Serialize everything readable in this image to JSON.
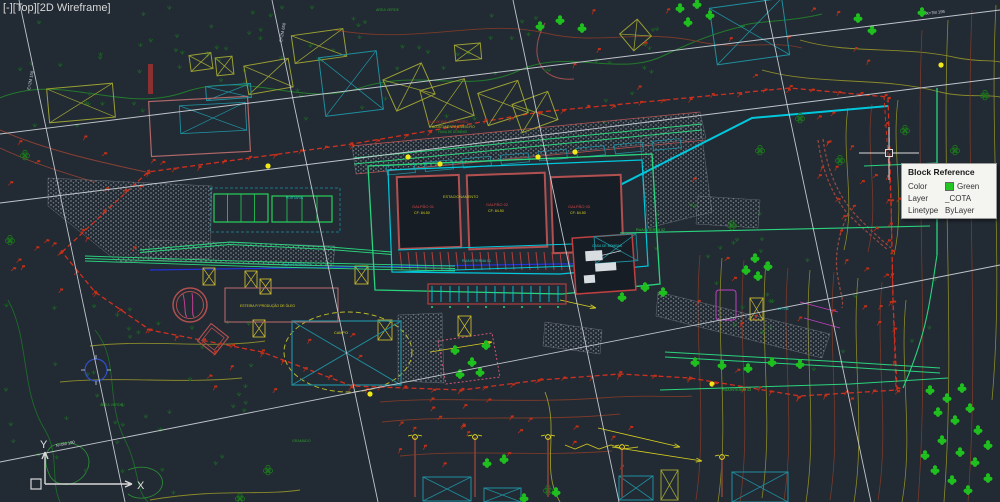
{
  "app": {
    "viewport_controls": {
      "minimize": "[-]",
      "view": "[Top]",
      "visual_style": "[2D Wireframe]"
    }
  },
  "tooltip": {
    "title": "Block Reference",
    "rows": [
      {
        "label": "Color",
        "value": "Green",
        "swatch": "#22c522"
      },
      {
        "label": "Layer",
        "value": "_COTA",
        "swatch": ""
      },
      {
        "label": "Linetype",
        "value": "ByLayer",
        "swatch": ""
      }
    ]
  },
  "ucs": {
    "x_label": "X",
    "y_label": "Y"
  },
  "palette": {
    "background": "#222a33",
    "crosshair": "#dcdcdc",
    "grid_line": "#c9ced5",
    "boundary_red": "#d03020",
    "marker_red": "#c23018",
    "pipe_green": "#2ad47e",
    "plant_green": "#1fbf1f",
    "cad_cyan": "#00c8dc",
    "cad_teal": "#1f8f9f",
    "cad_yellow": "#d8d020",
    "cad_olive": "#9aa033",
    "cad_blue": "#2233dd",
    "cad_salmon": "#b05050",
    "stipple_gray": "#98a0a8"
  },
  "grid_labels": [
    {
      "t": "X=7M 195",
      "x": 926,
      "y": 15,
      "r": -7
    },
    {
      "t": "N=0M 190",
      "x": 56,
      "y": 447,
      "r": -11
    },
    {
      "t": "E=2M 150",
      "x": 30,
      "y": 90,
      "r": -79
    },
    {
      "t": "E=2M 650",
      "x": 282,
      "y": 42,
      "r": -79
    }
  ],
  "drawing_labels": [
    {
      "t": "ESTACIONAMENTO",
      "x": 443,
      "y": 198,
      "c": "#c8c820",
      "s": 3.8
    },
    {
      "t": "GALPÃO 01",
      "x": 412,
      "y": 208,
      "c": "#d04848",
      "s": 4
    },
    {
      "t": "CF: 84.50",
      "x": 414,
      "y": 214,
      "c": "#d8d020",
      "s": 3.6
    },
    {
      "t": "GALPÃO 02",
      "x": 486,
      "y": 206,
      "c": "#d04848",
      "s": 4
    },
    {
      "t": "CF: 84.50",
      "x": 488,
      "y": 212,
      "c": "#d8d020",
      "s": 3.6
    },
    {
      "t": "GALPÃO 03",
      "x": 568,
      "y": 208,
      "c": "#d04848",
      "s": 4
    },
    {
      "t": "CF: 84.50",
      "x": 570,
      "y": 214,
      "c": "#d8d020",
      "s": 3.6
    },
    {
      "t": "RUA INTERNA 01",
      "x": 282,
      "y": 266,
      "c": "#20c8c8",
      "s": 3.6
    },
    {
      "t": "RUA INTERNA 01",
      "x": 462,
      "y": 262,
      "c": "#20c8c8",
      "s": 3.6
    },
    {
      "t": "RUA INTERNA 02",
      "x": 636,
      "y": 231,
      "c": "#28c828",
      "s": 3.6
    },
    {
      "t": "RUA INTERNA 03",
      "x": 722,
      "y": 391,
      "c": "#28c828",
      "s": 3.6
    },
    {
      "t": "ESTEIRA P/ PRODUÇÃO DE ÓLEO",
      "x": 240,
      "y": 307,
      "c": "#d8d020",
      "s": 3.4
    },
    {
      "t": "CAMPO",
      "x": 334,
      "y": 334,
      "c": "#d8d020",
      "s": 3.8
    },
    {
      "t": "ÁREA VERDE",
      "x": 376,
      "y": 11,
      "c": "#2a9a2a",
      "s": 3.6
    },
    {
      "t": "ÁREA VERDE",
      "x": 100,
      "y": 406,
      "c": "#2a9a2a",
      "s": 3.6
    },
    {
      "t": "GRAMADO",
      "x": 292,
      "y": 442,
      "c": "#2a9a2a",
      "s": 3.6
    },
    {
      "t": "RUA VICINAL SÃO PEDRO",
      "x": 428,
      "y": 123,
      "c": "#c03030",
      "s": 3.2
    },
    {
      "t": "ACOSTAMENTO E MEIO-FIO",
      "x": 432,
      "y": 128,
      "c": "#c8c820",
      "s": 3.2
    },
    {
      "t": "FAIXA DE DOMÍNIO",
      "x": 438,
      "y": 133,
      "c": "#28a828",
      "s": 3.2
    },
    {
      "t": "CASA DE BOMBAS",
      "x": 592,
      "y": 247,
      "c": "#20c8c8",
      "s": 3.4
    },
    {
      "t": "E.T.E.",
      "x": 596,
      "y": 270,
      "c": "#d8dde2",
      "s": 3.4
    },
    {
      "t": "PORTARIA",
      "x": 286,
      "y": 199,
      "c": "#20c8c8",
      "s": 3.4
    },
    {
      "t": "LT=7M",
      "x": 778,
      "y": 310,
      "c": "#20c8c8",
      "s": 3.4
    }
  ]
}
